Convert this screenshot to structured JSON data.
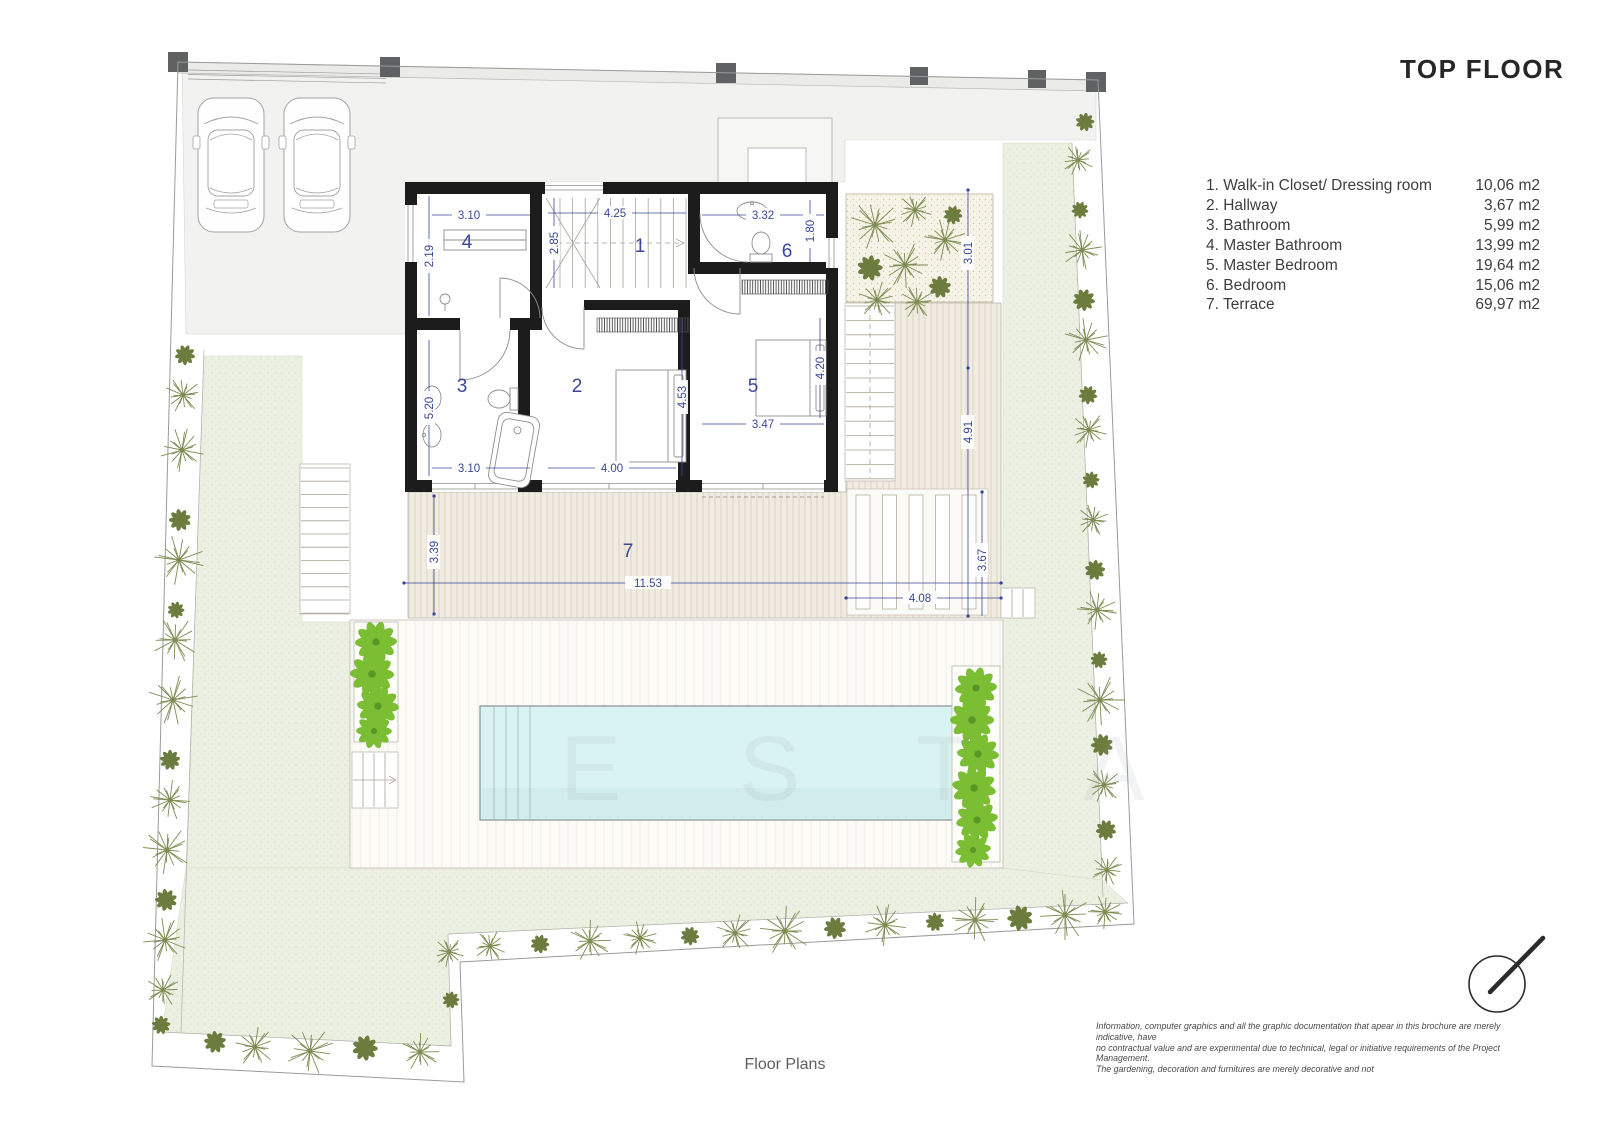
{
  "title": "TOP FLOOR",
  "legend": {
    "items": [
      {
        "label": "1. Walk-in Closet/ Dressing room",
        "area": "10,06 m2"
      },
      {
        "label": "2. Hallway",
        "area": "3,67 m2"
      },
      {
        "label": "3. Bathroom",
        "area": "5,99 m2"
      },
      {
        "label": "4. Master Bathroom",
        "area": "13,99 m2"
      },
      {
        "label": "5. Master Bedroom",
        "area": "19,64 m2"
      },
      {
        "label": "6. Bedroom",
        "area": "15,06 m2"
      },
      {
        "label": "7. Terrace",
        "area": "69,97 m2"
      }
    ]
  },
  "plan": {
    "room_numbers": [
      {
        "n": "1",
        "x": 640,
        "y": 252
      },
      {
        "n": "2",
        "x": 577,
        "y": 392
      },
      {
        "n": "3",
        "x": 462,
        "y": 392
      },
      {
        "n": "4",
        "x": 467,
        "y": 248
      },
      {
        "n": "5",
        "x": 753,
        "y": 392
      },
      {
        "n": "6",
        "x": 787,
        "y": 257
      },
      {
        "n": "7",
        "x": 628,
        "y": 557
      }
    ],
    "dimensions": [
      {
        "t": "3.10",
        "x": 469,
        "y": 215,
        "r": 0
      },
      {
        "t": "2.19",
        "x": 429,
        "y": 256,
        "r": -90
      },
      {
        "t": "4.25",
        "x": 615,
        "y": 213,
        "r": 0
      },
      {
        "t": "2.85",
        "x": 554,
        "y": 243,
        "r": -90
      },
      {
        "t": "3.32",
        "x": 763,
        "y": 215,
        "r": 0
      },
      {
        "t": "1.80",
        "x": 810,
        "y": 231,
        "r": -90
      },
      {
        "t": "5.20",
        "x": 429,
        "y": 408,
        "r": -90
      },
      {
        "t": "4.53",
        "x": 682,
        "y": 397,
        "r": -90
      },
      {
        "t": "4.20",
        "x": 820,
        "y": 368,
        "r": -90
      },
      {
        "t": "3.47",
        "x": 763,
        "y": 424,
        "r": 0
      },
      {
        "t": "3.10",
        "x": 469,
        "y": 468,
        "r": 0
      },
      {
        "t": "4.00",
        "x": 612,
        "y": 468,
        "r": 0
      },
      {
        "t": "3.01",
        "x": 968,
        "y": 253,
        "r": -90
      },
      {
        "t": "4.91",
        "x": 968,
        "y": 432,
        "r": -90
      },
      {
        "t": "3.67",
        "x": 982,
        "y": 560,
        "r": -90
      },
      {
        "t": "4.08",
        "x": 920,
        "y": 598,
        "r": 0
      },
      {
        "t": "3.39",
        "x": 434,
        "y": 552,
        "r": -90
      },
      {
        "t": "11.53",
        "x": 648,
        "y": 583,
        "r": 0
      }
    ],
    "colors": {
      "wall": "#1c1c1c",
      "dimension": "#3b4796",
      "lawn": "#ebf0e2",
      "deck": "#f1ece1",
      "pool": "#d9f3f2",
      "plant_olive": "#7e8c52",
      "plant_bright": "#7bbd33",
      "driveway": "#f2f2f0"
    }
  },
  "watermark": "E S T A",
  "footer": {
    "caption": "Floor Plans",
    "disclaimer_line1": "Information, computer graphics and all the graphic documentation that apear in this brochure are merely indicative, have",
    "disclaimer_line2": "no contractual value and are experimental due to technical, legal or initiative requirements of the Project Management.",
    "disclaimer_line3": "The gardening, decoration and furnitures are merely decorative and not"
  }
}
